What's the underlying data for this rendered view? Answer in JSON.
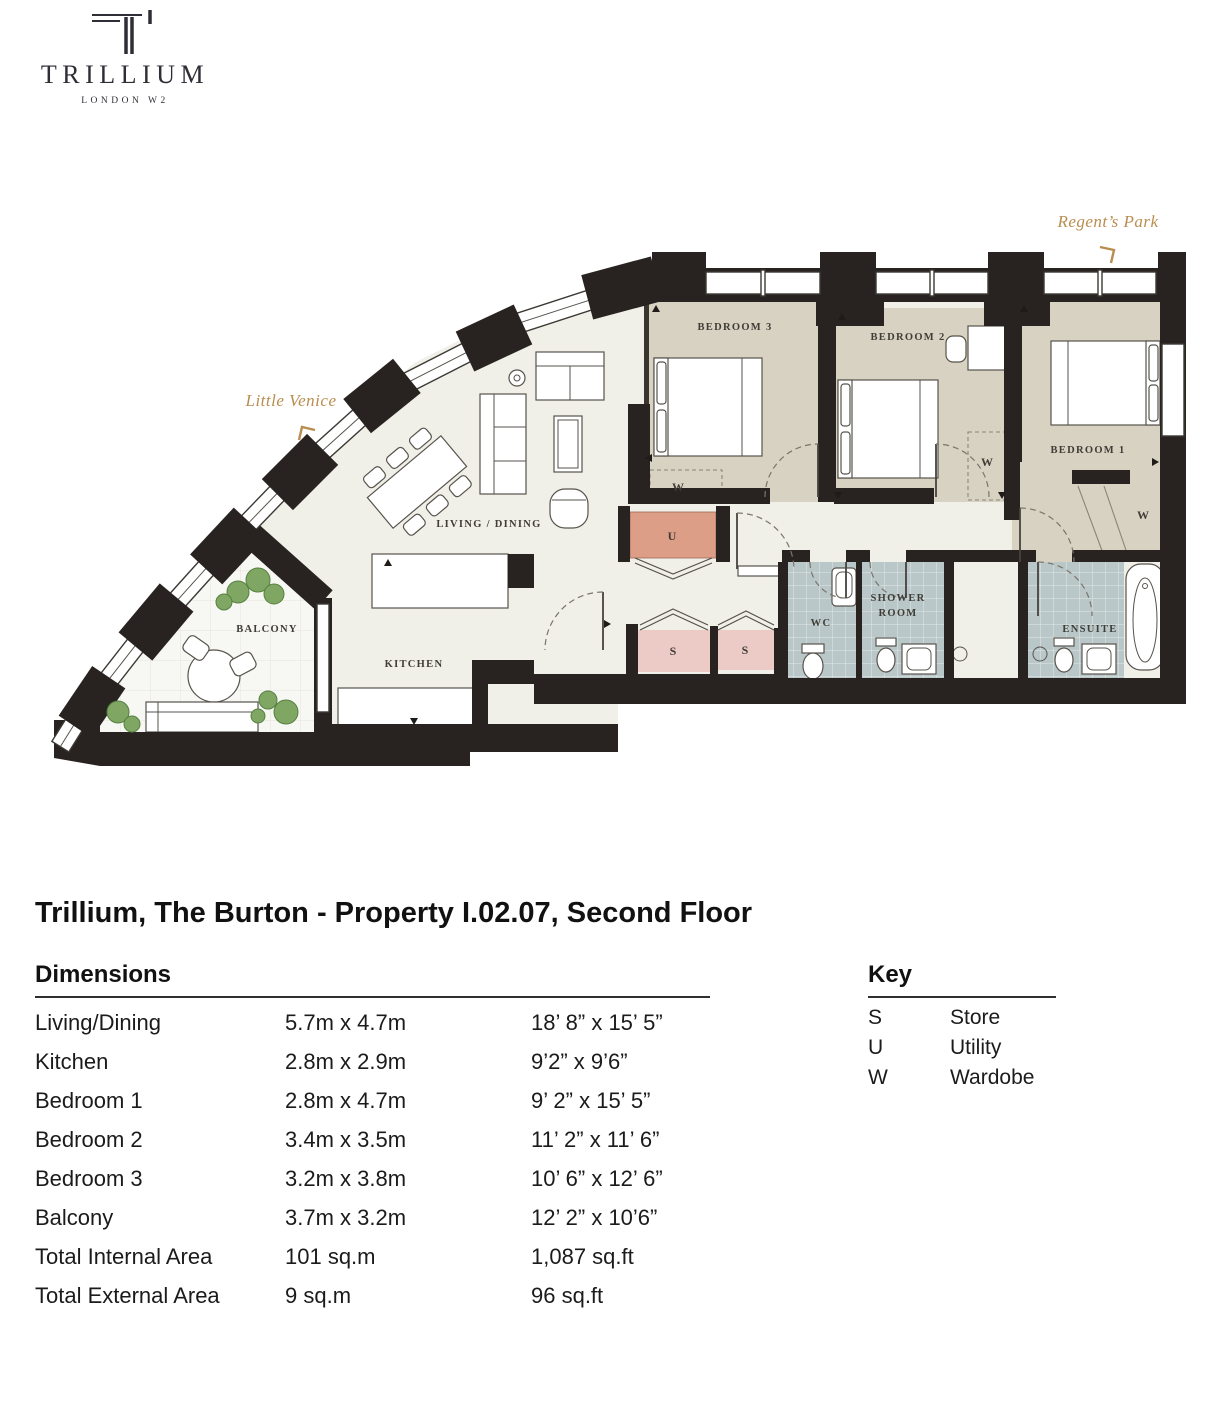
{
  "logo": {
    "brand": "TRILLIUM",
    "sub": "LONDON W2"
  },
  "plan": {
    "locations": {
      "little_venice": "Little Venice",
      "regents_park": "Regent’s Park"
    },
    "rooms": {
      "living": "LIVING / DINING",
      "kitchen": "KITCHEN",
      "balcony": "BALCONY",
      "bedroom1": "BEDROOM 1",
      "bedroom2": "BEDROOM 2",
      "bedroom3": "BEDROOM 3",
      "wc": "WC",
      "shower1": "SHOWER",
      "shower2": "ROOM",
      "ensuite": "ENSUITE",
      "utility": "U",
      "store": "S",
      "wardrobe": "W"
    }
  },
  "title": "Trillium, The Burton - Property I.02.07, Second Floor",
  "dimensions": {
    "heading": "Dimensions",
    "rows": [
      {
        "name": "Living/Dining",
        "metric": "5.7m x 4.7m",
        "imperial": "18’ 8” x 15’ 5”"
      },
      {
        "name": "Kitchen",
        "metric": "2.8m x 2.9m",
        "imperial": "9’2” x 9’6”"
      },
      {
        "name": "Bedroom 1",
        "metric": "2.8m x 4.7m",
        "imperial": "9’ 2” x 15’ 5”"
      },
      {
        "name": "Bedroom 2",
        "metric": "3.4m x 3.5m",
        "imperial": "11’ 2” x 11’ 6”"
      },
      {
        "name": "Bedroom 3",
        "metric": "3.2m x 3.8m",
        "imperial": "10’ 6” x 12’ 6”"
      },
      {
        "name": "Balcony",
        "metric": "3.7m x 3.2m",
        "imperial": "12’ 2” x 10’6”"
      },
      {
        "name": "Total Internal Area",
        "metric": "101 sq.m",
        "imperial": "1,087 sq.ft"
      },
      {
        "name": "Total External Area",
        "metric": "9 sq.m",
        "imperial": "96 sq.ft"
      }
    ]
  },
  "key": {
    "heading": "Key",
    "rows": [
      {
        "symbol": "S",
        "label": "Store"
      },
      {
        "symbol": "U",
        "label": "Utility"
      },
      {
        "symbol": "W",
        "label": "Wardobe"
      }
    ]
  },
  "colors": {
    "wall": "#282320",
    "bedroom_floor": "#d7d2c1",
    "living_floor": "#f0efe8",
    "bath_floor": "#b9c7c9",
    "utility_fill": "#dd9e88",
    "store_fill": "#eccac5",
    "balcony_floor": "#f7f7f3",
    "gold": "#b98d4f",
    "plant_green": "#7fa763",
    "text_dark": "#1b1b1b"
  }
}
